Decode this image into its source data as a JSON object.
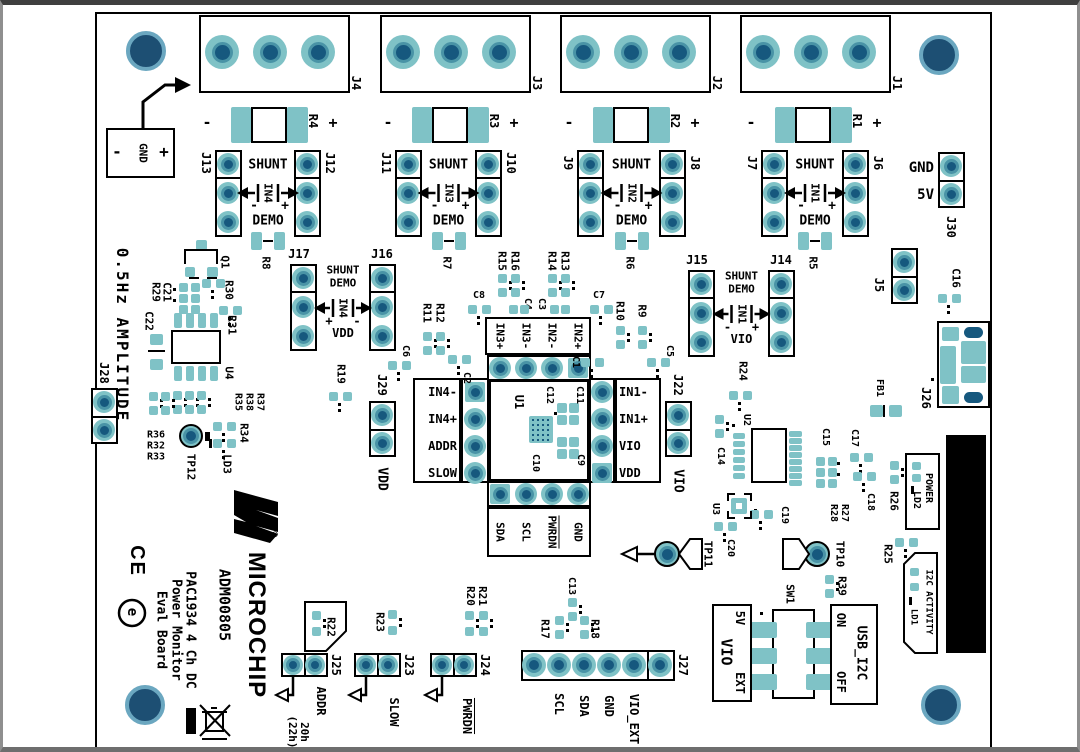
{
  "colors": {
    "pad_teal": "#7fc2c6",
    "pad_ring": "#4993a6",
    "drill_navy": "#16587e",
    "mount_navy": "#1d4f73",
    "silk": "#000000",
    "board": "#ffffff",
    "usb_shield": "#000000"
  },
  "branding": {
    "brand": "MICROCHIP",
    "reg": "®",
    "model": "ADM00805",
    "description": "PAC1934 4 Ch DC\nPower Monitor\nEval Board",
    "ce_mark": "CE",
    "e_mark": "e",
    "amplitude_note": "0.5Hz AMPLITUDE"
  },
  "gnd_input": {
    "minus": "-",
    "label": "GND",
    "plus": "+"
  },
  "terminal_blocks": [
    {
      "label": "J4"
    },
    {
      "label": "J3"
    },
    {
      "label": "J2"
    },
    {
      "label": "J1"
    }
  ],
  "sense_resistors": [
    {
      "minus": "-",
      "label": "R4",
      "plus": "+"
    },
    {
      "minus": "-",
      "label": "R3",
      "plus": "+"
    },
    {
      "minus": "-",
      "label": "R2",
      "plus": "+"
    },
    {
      "minus": "-",
      "label": "R1",
      "plus": "+"
    }
  ],
  "channels_top": [
    {
      "left": "J13",
      "right": "J12",
      "shunt": "SHUNT",
      "signal": "IN4",
      "minus": "-",
      "plus": "+",
      "demo": "DEMO",
      "demo_res": "R8"
    },
    {
      "left": "J11",
      "right": "J10",
      "shunt": "SHUNT",
      "signal": "IN3",
      "minus": "-",
      "plus": "+",
      "demo": "DEMO",
      "demo_res": "R7"
    },
    {
      "left": "J9",
      "right": "J8",
      "shunt": "SHUNT",
      "signal": "IN2",
      "minus": "-",
      "plus": "+",
      "demo": "DEMO",
      "demo_res": "R6"
    },
    {
      "left": "J7",
      "right": "J6",
      "shunt": "SHUNT",
      "signal": "IN1",
      "minus": "-",
      "plus": "+",
      "demo": "DEMO",
      "demo_res": "R5"
    }
  ],
  "channels_mid": [
    {
      "left": "J17",
      "right": "J16",
      "shunt": "SHUNT",
      "demo": "DEMO",
      "signal": "IN4",
      "sign_left": "+",
      "sign_right": "-",
      "rail": "VDD"
    },
    {
      "left": "J15",
      "right": "J14",
      "shunt": "SHUNT",
      "demo": "DEMO",
      "signal": "IN1",
      "sign_left": "-",
      "sign_right": "+",
      "rail": "VIO"
    }
  ],
  "power_header": {
    "gnd": "GND",
    "v5": "5V",
    "label": "J30"
  },
  "u1": {
    "label": "U1",
    "top": [
      "IN3+",
      "IN3-",
      "IN2-",
      "IN2+"
    ],
    "left": [
      "IN4-",
      "IN4+",
      "ADDR",
      "SLOW"
    ],
    "right": [
      "IN1-",
      "IN1+",
      "VIO",
      "VDD"
    ],
    "bottom": [
      "SDA",
      "SCL",
      "PWRDN",
      "GND"
    ]
  },
  "j27": {
    "label": "J27",
    "pins": [
      "SCL",
      "SDA",
      "GND",
      "VIO_EXT"
    ]
  },
  "jumpers": [
    {
      "label": "J25",
      "res": "R22",
      "signal": "ADDR",
      "note": "20h\n(22h)"
    },
    {
      "label": "J23",
      "res": "R23",
      "signal": "SLOW"
    },
    {
      "label": "J24",
      "res": "R21\nR20",
      "signal": "PWRDN"
    }
  ],
  "testpoints": {
    "tp12": "TP12",
    "tp11": {
      "label": "TP11",
      "net": "GND"
    },
    "tp10": {
      "label": "TP10",
      "net": "5V"
    }
  },
  "switch": {
    "label": "SW1",
    "vio_box": {
      "top": "5V",
      "name": "VIO",
      "bottom": "EXT"
    },
    "usb_box": {
      "top": "ON",
      "name": "USB_I2C",
      "bottom": "OFF"
    }
  },
  "leds": {
    "power": {
      "box": "POWER",
      "led": "LD2"
    },
    "i2c": {
      "box": "I2C ACTIVITY",
      "led": "LD1"
    },
    "ld3": "LD3"
  },
  "refs": {
    "R9": "R9",
    "R10": "R10",
    "R11": "R11",
    "R12": "R12",
    "R13": "R13",
    "R14": "R14",
    "R15": "R15",
    "R16": "R16",
    "R17": "R17",
    "R18": "R18",
    "R19": "R19",
    "R24": "R24",
    "R25": "R25",
    "R26": "R26",
    "R27_28": "R27\nR28",
    "R29": "R29",
    "R30": "R30",
    "R31": "R31",
    "R34": "R34",
    "R36_32_33": "R36\nR32\nR33",
    "R37_38_35": "R37\nR38\nR35",
    "R39": "R39",
    "C1": "C1",
    "C2": "C2",
    "C3": "C3",
    "C4": "C4",
    "C5": "C5",
    "C6": "C6",
    "C7": "C7",
    "C8": "C8",
    "C9": "C9",
    "C10": "C10",
    "C11": "C11",
    "C12": "C12",
    "C13": "C13",
    "C14": "C14",
    "C15": "C15",
    "C16": "C16",
    "C17": "C17",
    "C18": "C18",
    "C19": "C19",
    "C20": "C20",
    "C21": "C21",
    "C22": "C22",
    "Q1": "Q1",
    "U2": "U2",
    "U3": "U3",
    "U4": "U4",
    "FB1": "FB1",
    "J5": "J5",
    "J22": "J22",
    "J26": "J26",
    "J28": "J28",
    "J29": "J29",
    "VDD": "VDD",
    "VIO": "VIO"
  }
}
